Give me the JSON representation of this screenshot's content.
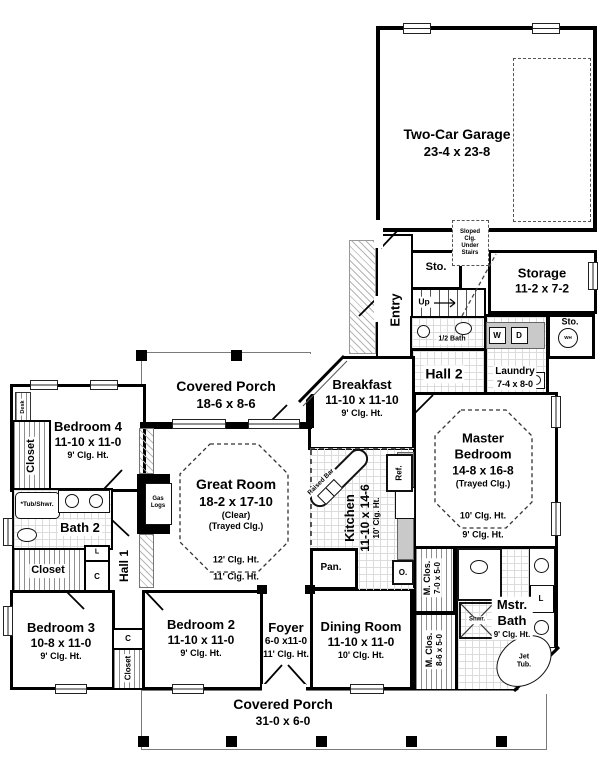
{
  "colors": {
    "wall": "#000000",
    "tile_line": "#dcdcdc",
    "counter_gray": "#c9c9c9",
    "porch_line": "#7a7a7a"
  },
  "labels": {
    "garage_name": "Two-Car Garage",
    "garage_dims": "23-4 x 23-8",
    "sloped_note": "Sloped\nClg.\nUnder\nStairs",
    "sto_stairs": "Sto.",
    "storage_name": "Storage",
    "storage_dims": "11-2 x 7-2",
    "up": "Up",
    "entry": "Entry",
    "half_bath": "1/2 Bath",
    "washer": "W",
    "dryer": "D",
    "water_heater": "WH",
    "sto_wh": "Sto.",
    "hall2": "Hall 2",
    "laundry_name": "Laundry",
    "laundry_dims": "7-4 x 8-0",
    "porch_top_name": "Covered Porch",
    "porch_top_dims": "18-6 x 8-6",
    "breakfast_name": "Breakfast",
    "breakfast_dims": "11-10 x 11-10",
    "breakfast_clg": "9' Clg. Ht.",
    "master_name": "Master Bedroom",
    "master_dims": "14-8 x 16-8",
    "master_note": "(Trayed Clg.)",
    "master_clg1": "10' Clg. Ht.",
    "master_clg2": "9' Clg. Ht.",
    "desk": "Desk",
    "bedroom4_name": "Bedroom 4",
    "bedroom4_dims": "11-10 x 11-0",
    "bedroom4_clg": "9' Clg. Ht.",
    "closet_b4": "Closet",
    "great_name": "Great Room",
    "great_dims": "18-2 x 17-10",
    "great_note1": "(Clear)",
    "great_note2": "(Trayed Clg.)",
    "great_clg1": "12' Clg. Ht.",
    "great_clg2": "11' Clg. Ht.",
    "gas_logs": "Gas\nLogs",
    "raised_bar": "Raised Bar",
    "kitchen_name": "Kitchen",
    "kitchen_dims": "11-10 x 14-6",
    "kitchen_clg": "10' Clg. Ht.",
    "refrigerator": "Ref.",
    "tub_shwr": "*Tub/Shwr.",
    "bath2": "Bath 2",
    "linen1": "L",
    "closet_c1": "C",
    "closet_hall": "Closet",
    "hall1": "Hall 1",
    "bedroom3_name": "Bedroom 3",
    "bedroom3_dims": "10-8 x 11-0",
    "bedroom3_clg": "9' Clg. Ht.",
    "closet_c2": "C",
    "closet_b2": "Closet",
    "bedroom2_name": "Bedroom 2",
    "bedroom2_dims": "11-10 x 11-0",
    "bedroom2_clg": "9' Clg. Ht.",
    "foyer_name": "Foyer",
    "foyer_dims": "6-0 x11-0",
    "foyer_clg": "11' Clg. Ht.",
    "dining_name": "Dining Room",
    "dining_dims": "11-10 x 11-0",
    "dining_clg": "10' Clg. Ht.",
    "mclos1_name": "M. Clos.",
    "mclos1_dims": "7-0 x 5-0",
    "mclos2_name": "M. Clos.",
    "mclos2_dims": "8-6 x 5-0",
    "shower": "Shwr.",
    "mbath_name1": "Mstr.",
    "mbath_name2": "Bath",
    "mbath_clg": "9' Clg. Ht.",
    "linen2": "L",
    "jet_tub": "Jet\nTub.",
    "pantry": "Pan.",
    "oven": "O.",
    "porch_bottom_name": "Covered Porch",
    "porch_bottom_dims": "31-0 x 6-0"
  }
}
